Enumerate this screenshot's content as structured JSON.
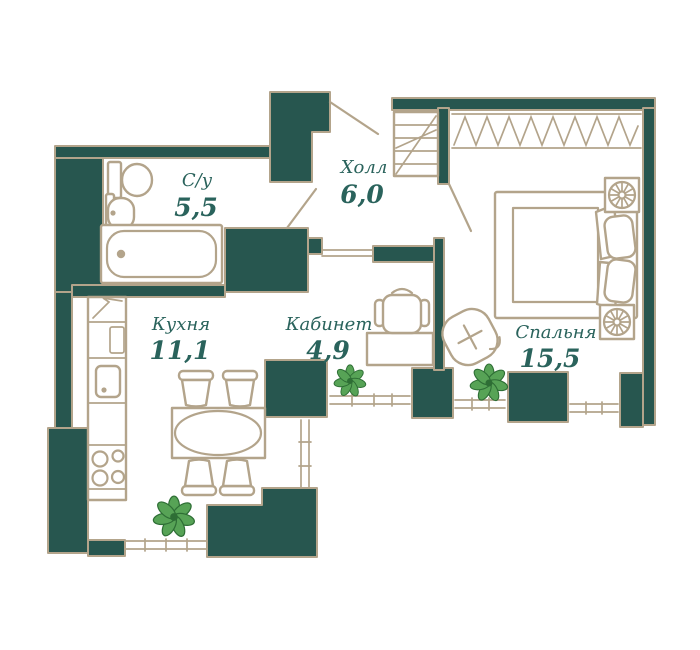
{
  "plan": {
    "rooms": [
      {
        "id": "bathroom",
        "name": "С/у",
        "area": "5,5"
      },
      {
        "id": "hall",
        "name": "Холл",
        "area": "6,0"
      },
      {
        "id": "kitchen",
        "name": "Кухня",
        "area": "11,1"
      },
      {
        "id": "office",
        "name": "Кабинет",
        "area": "4,9"
      },
      {
        "id": "bedroom",
        "name": "Спальня",
        "area": "15,5"
      }
    ]
  },
  "colors": {
    "wall": "#27564f",
    "line": "#b3a48b",
    "text": "#2a635c",
    "plant": "#57a356",
    "plantdark": "#2e6e35",
    "bg": "#ffffff"
  }
}
